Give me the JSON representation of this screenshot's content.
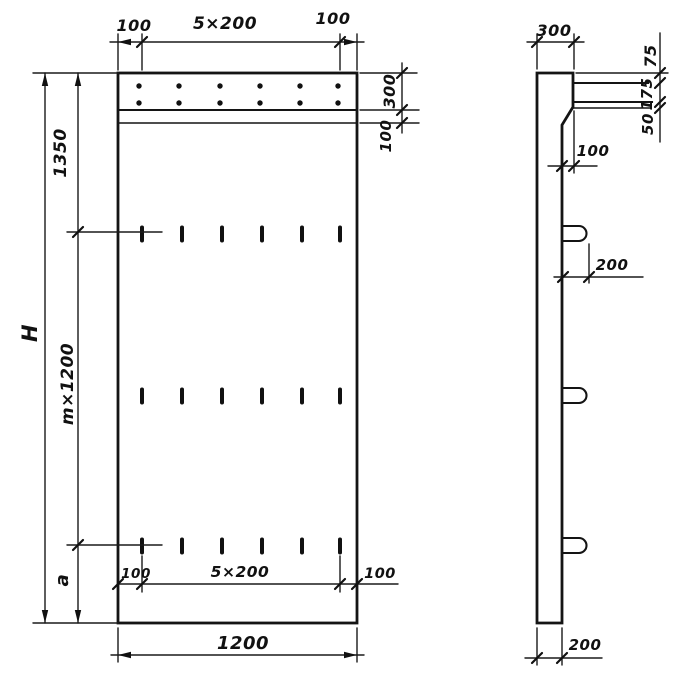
{
  "front_view": {
    "top_dim": {
      "left": "100",
      "middle": "5×200",
      "right": "100"
    },
    "band_dim": {
      "height": "300",
      "strip": "100"
    },
    "left_dim": {
      "upper": "1350",
      "middle": "m×1200",
      "lower": "a",
      "overall": "H"
    },
    "inner_bottom_dim": {
      "left": "100",
      "middle": "5×200",
      "right": "100"
    },
    "bottom_dim": {
      "width": "1200"
    }
  },
  "side_view": {
    "top_dim": {
      "width": "300"
    },
    "right_dim": {
      "top": "75",
      "middle": "175",
      "bottom": "50"
    },
    "ledge_dim": {
      "offset": "100"
    },
    "hook_dim": {
      "length": "200"
    },
    "bottom_dim": {
      "thickness": "200"
    }
  }
}
